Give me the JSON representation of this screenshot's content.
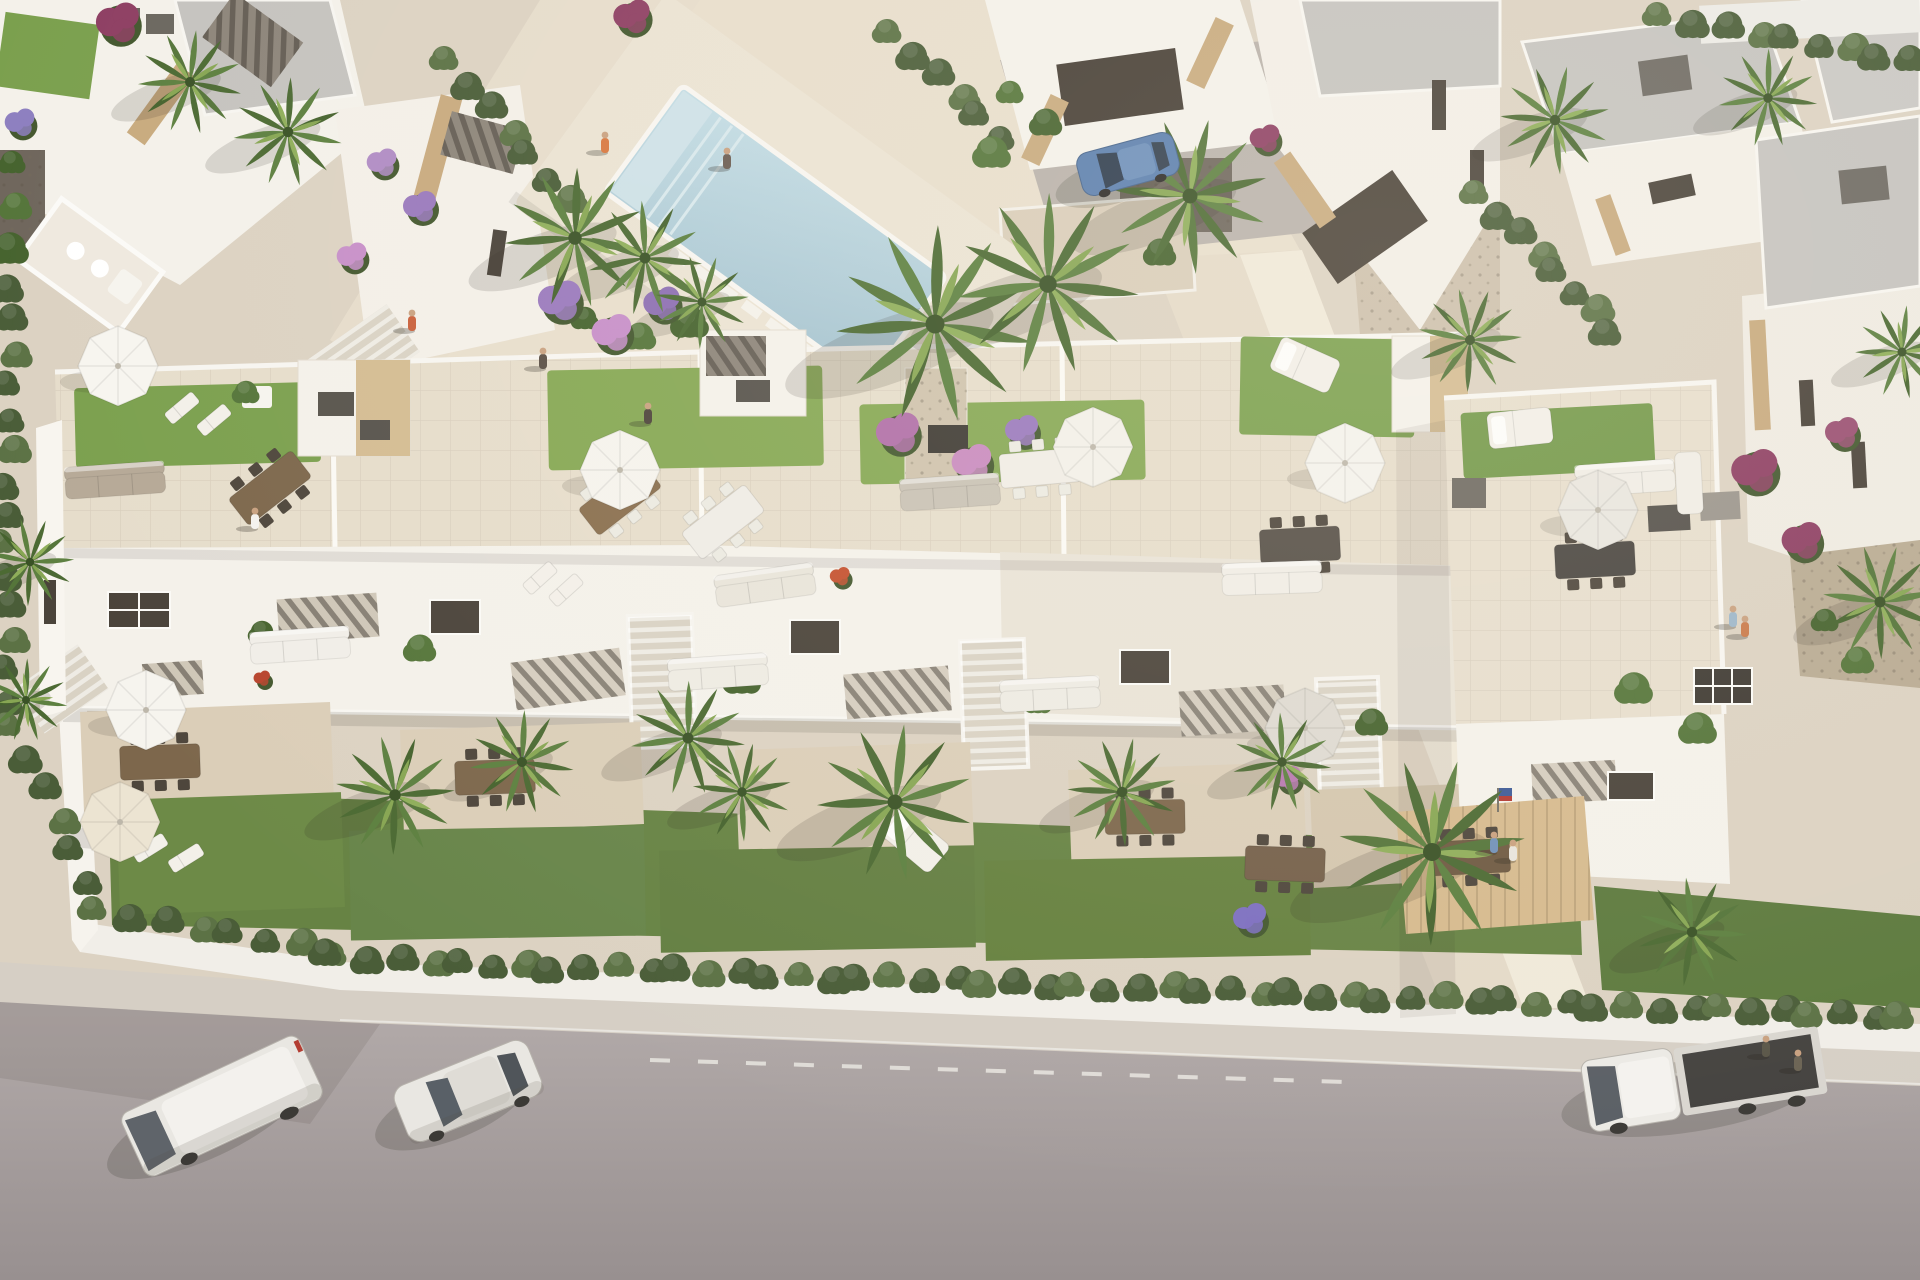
{
  "meta": {
    "label": "Aerial 3D architectural render of a modern white residential complex with rooftop terraces, communal pool, palm gardens and a street with parked vehicles",
    "width": 1920,
    "height": 1280
  },
  "palette": {
    "plaza": "#dcd2c2",
    "plazaLight": "#e9dfcd",
    "path": "#e4dac8",
    "road": "#aba3a0",
    "roadDark": "#998f8d",
    "sidewalk": "#d6cfc5",
    "wall": "#f1eee8",
    "white": "#f4f1ea",
    "whiteShade": "#ddd6ca",
    "roof": "#c5c3bf",
    "stone": "#c8aa7e",
    "stoneLight": "#d4bc92",
    "lawn": "#7ba04e",
    "lawnBright": "#86a854",
    "gardenGreen": "#678344",
    "hedge": "#4a5d38",
    "hedgeLight": "#5c7245",
    "pool": "#b7d0da",
    "poolShelf": "#cfe2e8",
    "wood": "#d6ba8e",
    "gravel": "#b3a58e",
    "dark": "#55504a",
    "terrace": "#dbceb8",
    "shadow": "#2e2a22"
  },
  "scene": {
    "palms": [
      [
        190,
        82,
        1
      ],
      [
        288,
        132,
        1.05
      ],
      [
        575,
        238,
        1.35
      ],
      [
        645,
        258,
        1.1
      ],
      [
        702,
        302,
        0.9
      ],
      [
        935,
        324,
        1.9
      ],
      [
        1048,
        284,
        1.75
      ],
      [
        1190,
        196,
        1.5
      ],
      [
        1470,
        340,
        1
      ],
      [
        1555,
        120,
        1.05
      ],
      [
        1768,
        98,
        0.95
      ],
      [
        1902,
        352,
        0.9
      ],
      [
        1880,
        602,
        1.1
      ],
      [
        395,
        795,
        1.15
      ],
      [
        522,
        762,
        1
      ],
      [
        688,
        738,
        1.1
      ],
      [
        742,
        792,
        0.95
      ],
      [
        895,
        802,
        1.5
      ],
      [
        1122,
        792,
        1.05
      ],
      [
        1282,
        762,
        0.95
      ],
      [
        1432,
        852,
        1.8
      ],
      [
        1692,
        932,
        1.05
      ],
      [
        30,
        562,
        0.85
      ],
      [
        26,
        700,
        0.8
      ]
    ],
    "parasols": [
      [
        118,
        366,
        "#f7f5ef"
      ],
      [
        620,
        470,
        "#f5f3ed"
      ],
      [
        1093,
        447,
        "#f3f0e9"
      ],
      [
        1345,
        463,
        "#f4f2ec"
      ],
      [
        1598,
        510,
        "#e9e6df"
      ],
      [
        146,
        710,
        "#f6f4ee"
      ],
      [
        120,
        822,
        "#ece4d2"
      ],
      [
        1305,
        728,
        "#dedad1"
      ]
    ],
    "people": [
      [
        255,
        522,
        "#f4f2ee"
      ],
      [
        605,
        146,
        "#d87840"
      ],
      [
        727,
        162,
        "#6b5d52"
      ],
      [
        543,
        362,
        "#5a4f45"
      ],
      [
        648,
        417,
        "#4e453c"
      ],
      [
        412,
        324,
        "#c9603b"
      ],
      [
        1494,
        846,
        "#7191b8"
      ],
      [
        1513,
        854,
        "#e8e4dc"
      ],
      [
        1733,
        620,
        "#9db6c9"
      ],
      [
        1745,
        630,
        "#c97a4a"
      ],
      [
        1766,
        1050,
        "#5a5648"
      ],
      [
        1798,
        1064,
        "#6b6354"
      ]
    ],
    "vehicles": [
      {
        "type": "van",
        "x": 222,
        "y": 1106,
        "rot": -25
      },
      {
        "type": "car",
        "x": 468,
        "y": 1091,
        "rot": -22
      },
      {
        "type": "pickup",
        "x": 1706,
        "y": 1078,
        "rot": -9
      },
      {
        "type": "hatch",
        "x": 1128,
        "y": 164,
        "rot": -15
      }
    ],
    "hedges": [
      {
        "a": [
          340,
          958
        ],
        "b": [
          1905,
          1016
        ],
        "n": 52
      },
      {
        "a": [
          10,
          255
        ],
        "b": [
          10,
          515
        ],
        "n": 9
      },
      {
        "a": [
          8,
          545
        ],
        "b": [
          8,
          700
        ],
        "n": 6
      },
      {
        "a": [
          14,
          728
        ],
        "b": [
          88,
          880
        ],
        "n": 6
      },
      {
        "a": [
          100,
          912
        ],
        "b": [
          332,
          948
        ],
        "n": 8
      },
      {
        "a": [
          452,
          62
        ],
        "b": [
          566,
          200
        ],
        "n": 7
      },
      {
        "a": [
          1482,
          196
        ],
        "b": [
          1612,
          328
        ],
        "n": 8
      },
      {
        "a": [
          1665,
          18
        ],
        "b": [
          1912,
          58
        ],
        "n": 9
      },
      {
        "a": [
          895,
          35
        ],
        "b": [
          1000,
          135
        ],
        "n": 6
      }
    ],
    "flowers": [
      [
        560,
        300,
        26,
        "#9a79bd"
      ],
      [
        612,
        332,
        24,
        "#c78fc9"
      ],
      [
        662,
        303,
        22,
        "#8d6fb3"
      ],
      [
        898,
        432,
        26,
        "#b06fa8"
      ],
      [
        972,
        462,
        24,
        "#c98bbf"
      ],
      [
        1022,
        430,
        20,
        "#9a79bd"
      ],
      [
        420,
        206,
        20,
        "#9a79bd"
      ],
      [
        382,
        162,
        18,
        "#b08cc4"
      ],
      [
        352,
        256,
        18,
        "#c78fc9"
      ],
      [
        118,
        22,
        26,
        "#8e3f63"
      ],
      [
        632,
        16,
        22,
        "#8e3f63"
      ],
      [
        20,
        122,
        18,
        "#8d7fc0"
      ],
      [
        516,
        772,
        22,
        "#7d6fc0"
      ],
      [
        1250,
        918,
        20,
        "#7d6fc0"
      ],
      [
        1288,
        778,
        16,
        "#b879b0"
      ],
      [
        1755,
        470,
        28,
        "#8e3f63"
      ],
      [
        1802,
        540,
        24,
        "#8e3f63"
      ],
      [
        1842,
        432,
        20,
        "#9a4f72"
      ],
      [
        1265,
        138,
        18,
        "#8e3f63"
      ],
      [
        840,
        576,
        12,
        "#c4512f"
      ],
      [
        262,
        678,
        10,
        "#b8452e"
      ]
    ],
    "bushes": [
      [
        585,
        318
      ],
      [
        640,
        336
      ],
      [
        690,
        322
      ],
      [
        1010,
        92
      ],
      [
        1046,
        122
      ],
      [
        992,
        152
      ],
      [
        262,
        632
      ],
      [
        420,
        648
      ],
      [
        742,
        678
      ],
      [
        1038,
        702
      ],
      [
        1372,
        722
      ],
      [
        1634,
        688
      ],
      [
        12,
        162
      ],
      [
        16,
        206
      ],
      [
        10,
        248
      ],
      [
        246,
        392
      ],
      [
        1160,
        252
      ],
      [
        1698,
        728
      ],
      [
        1825,
        620
      ],
      [
        1858,
        660
      ]
    ],
    "dining": [
      {
        "x": 270,
        "y": 488,
        "rot": -38,
        "c": "#7d674c",
        "k": "dark"
      },
      {
        "x": 620,
        "y": 498,
        "rot": -38,
        "c": "#8a6f4f",
        "k": "light"
      },
      {
        "x": 1040,
        "y": 468,
        "rot": -5,
        "c": "#f0ede6",
        "k": "light"
      },
      {
        "x": 723,
        "y": 522,
        "rot": -38,
        "c": "#efece6",
        "k": "light"
      },
      {
        "x": 1300,
        "y": 545,
        "rot": -3,
        "c": "#564f47",
        "k": "dark"
      },
      {
        "x": 1595,
        "y": 560,
        "rot": -3,
        "c": "#4a4641",
        "k": "dark"
      },
      {
        "x": 160,
        "y": 762,
        "rot": -2,
        "c": "#7d674c",
        "k": "dark"
      },
      {
        "x": 495,
        "y": 777,
        "rot": -2,
        "c": "#7d674c",
        "k": "dark"
      },
      {
        "x": 1145,
        "y": 817,
        "rot": -1,
        "c": "#7d674c",
        "k": "dark"
      },
      {
        "x": 1285,
        "y": 864,
        "rot": 2,
        "c": "#75604a",
        "k": "dark"
      },
      {
        "x": 1470,
        "y": 857,
        "rot": -3,
        "c": "#6f5a42",
        "k": "dark"
      }
    ],
    "sofas": [
      {
        "x": 115,
        "y": 480,
        "rot": -4,
        "c": "#b6a997"
      },
      {
        "x": 765,
        "y": 585,
        "rot": -8,
        "c": "#e8e4da"
      },
      {
        "x": 1625,
        "y": 478,
        "rot": -4,
        "c": "#f0ede6"
      },
      {
        "x": 1272,
        "y": 578,
        "rot": -2,
        "c": "#f0ede6"
      },
      {
        "x": 300,
        "y": 645,
        "rot": -4,
        "c": "#f1eee8"
      },
      {
        "x": 718,
        "y": 672,
        "rot": -4,
        "c": "#eeebe3"
      },
      {
        "x": 1050,
        "y": 694,
        "rot": -3,
        "c": "#eeebe3"
      },
      {
        "x": 950,
        "y": 492,
        "rot": -4,
        "c": "#c9c2b5"
      }
    ],
    "daybeds": [
      {
        "x": 1305,
        "y": 365,
        "rot": 24
      },
      {
        "x": 1520,
        "y": 428,
        "rot": -6
      },
      {
        "x": 915,
        "y": 840,
        "rot": 40
      }
    ],
    "loungers": [
      [
        182,
        408,
        -40
      ],
      [
        214,
        420,
        -40
      ],
      [
        540,
        578,
        -42
      ],
      [
        566,
        590,
        -42
      ],
      [
        150,
        848,
        -32
      ],
      [
        186,
        858,
        -32
      ]
    ],
    "roadDash": {
      "x1": 650,
      "y1": 1060,
      "x2": 1345,
      "y2": 1082
    }
  }
}
